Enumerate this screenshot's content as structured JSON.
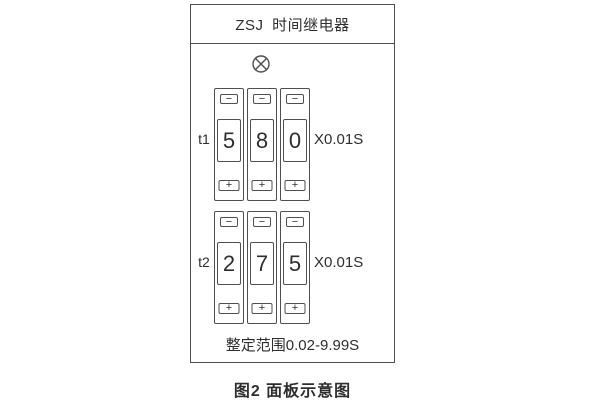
{
  "colors": {
    "line": "#4f4f4f",
    "text": "#2e2e2e",
    "background": "#ffffff"
  },
  "panel": {
    "title": "ZSJ 时间继电器",
    "lamp_icon": "indicator-lamp",
    "groups": [
      {
        "label": "t1",
        "digits": [
          "5",
          "8",
          "0"
        ],
        "multiplier": "X0.01S"
      },
      {
        "label": "t2",
        "digits": [
          "2",
          "7",
          "5"
        ],
        "multiplier": "X0.01S"
      }
    ],
    "range_text": "整定范围0.02-9.99S"
  },
  "buttons": {
    "minus": "−",
    "plus": "+"
  },
  "caption": "图2 面板示意图"
}
